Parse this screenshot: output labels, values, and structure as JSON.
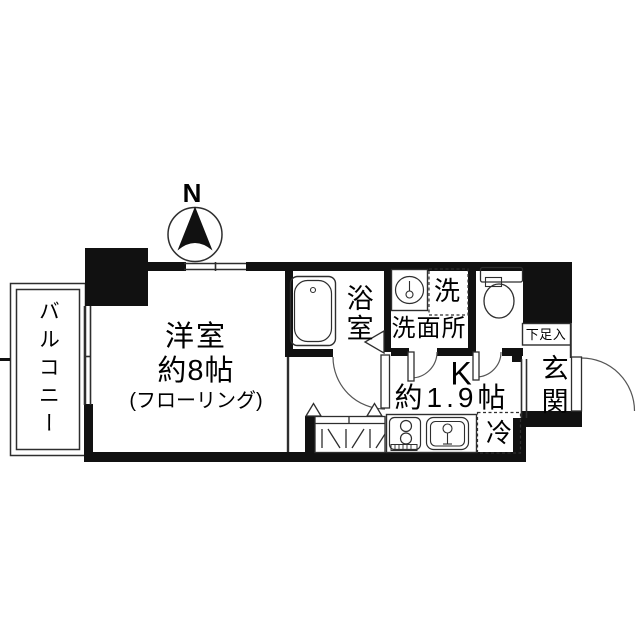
{
  "compass": {
    "north": "N"
  },
  "balcony": {
    "label": "バルコニー"
  },
  "main_room": {
    "name": "洋室",
    "size": "約8帖",
    "floor_note": "(フローリング)"
  },
  "bathroom": {
    "label": "浴室"
  },
  "washroom": {
    "label": "洗面所",
    "washer": "洗"
  },
  "kitchen": {
    "label": "K",
    "size": "約1.9帖",
    "fridge": "冷"
  },
  "entrance": {
    "label": "玄関",
    "shoe_box": "下足入"
  },
  "colors": {
    "wall": "#111111",
    "line": "#2e2e2e",
    "bg": "#ffffff",
    "text": "#000000"
  }
}
